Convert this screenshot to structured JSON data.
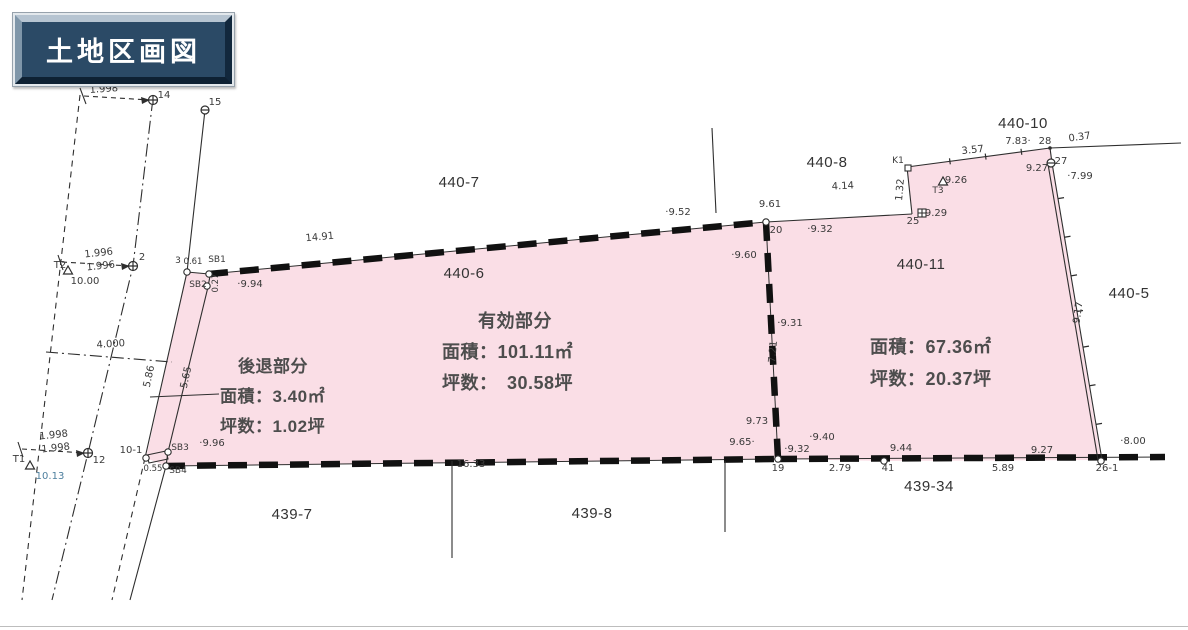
{
  "title": "土地区画図",
  "colors": {
    "parcel_fill": "#fadee6",
    "line": "#2e2e2e",
    "boundary": "#111111",
    "title_bg": "#2b4a66",
    "title_text": "#ffffff",
    "label_gray": "#3a3a3a",
    "elevation_blue": "#4d7f9e"
  },
  "info_blocks": {
    "effective": {
      "heading": "有効部分",
      "area": "面積：101.11㎡",
      "tsubo": "坪数：　30.58坪"
    },
    "setback": {
      "heading": "後退部分",
      "area": "面積：3.40㎡",
      "tsubo": "坪数：1.02坪"
    },
    "parcel_440_11": {
      "area": "面積：67.36㎡",
      "tsubo": "坪数：20.37坪"
    }
  },
  "parcel_labels": [
    {
      "t": "440-7",
      "x": 459,
      "y": 187
    },
    {
      "t": "440-8",
      "x": 827,
      "y": 167
    },
    {
      "t": "440-10",
      "x": 1023,
      "y": 128
    },
    {
      "t": "440-5",
      "x": 1129,
      "y": 298
    },
    {
      "t": "440-6",
      "x": 464,
      "y": 278
    },
    {
      "t": "440-11",
      "x": 921,
      "y": 269
    },
    {
      "t": "439-7",
      "x": 292,
      "y": 519
    },
    {
      "t": "439-8",
      "x": 592,
      "y": 518
    },
    {
      "t": "439-34",
      "x": 929,
      "y": 491
    }
  ],
  "survey_labels": [
    {
      "t": "1.998",
      "x": 104,
      "y": 92,
      "r": -4
    },
    {
      "t": "14",
      "x": 164,
      "y": 98
    },
    {
      "t": "15",
      "x": 215,
      "y": 105
    },
    {
      "t": "1.996",
      "x": 99,
      "y": 256,
      "r": -6
    },
    {
      "t": "1.996",
      "x": 101,
      "y": 269,
      "r": -6
    },
    {
      "t": "2",
      "x": 142,
      "y": 260
    },
    {
      "t": "T2",
      "x": 60,
      "y": 268
    },
    {
      "t": "10.00",
      "x": 85,
      "y": 284
    },
    {
      "t": "4.000",
      "x": 111,
      "y": 347,
      "r": -4
    },
    {
      "t": "5.86",
      "x": 152,
      "y": 377,
      "r": -78
    },
    {
      "t": "5.65",
      "x": 189,
      "y": 378,
      "r": -78
    },
    {
      "t": "1.998",
      "x": 54,
      "y": 438,
      "r": -6
    },
    {
      "t": "1.998",
      "x": 56,
      "y": 451,
      "r": -6
    },
    {
      "t": "12",
      "x": 99,
      "y": 463
    },
    {
      "t": "T1",
      "x": 19,
      "y": 462
    },
    {
      "t": "10.13",
      "x": 50,
      "y": 479,
      "c": "blue"
    },
    {
      "t": "10-1",
      "x": 131,
      "y": 453
    },
    {
      "t": "0.55",
      "x": 153,
      "y": 471,
      "s": 8.5
    },
    {
      "t": "SB3",
      "x": 180,
      "y": 450,
      "s": 9
    },
    {
      "t": "SB4",
      "x": 178,
      "y": 473,
      "s": 9
    },
    {
      "t": "3",
      "x": 178,
      "y": 263,
      "s": 9
    },
    {
      "t": "0.61",
      "x": 193,
      "y": 264,
      "s": 8.5
    },
    {
      "t": "SB1",
      "x": 217,
      "y": 262,
      "s": 9
    },
    {
      "t": "SB2",
      "x": 198,
      "y": 287,
      "s": 9
    },
    {
      "t": "0.27",
      "x": 218,
      "y": 283,
      "r": -90,
      "s": 8.5
    },
    {
      "t": "·9.96",
      "x": 212,
      "y": 446
    },
    {
      "t": "·9.94",
      "x": 250,
      "y": 287
    },
    {
      "t": "14.91",
      "x": 320,
      "y": 240,
      "r": -5
    },
    {
      "t": "·9.52",
      "x": 678,
      "y": 215
    },
    {
      "t": "16.33",
      "x": 471,
      "y": 467
    },
    {
      "t": "9.61",
      "x": 770,
      "y": 207
    },
    {
      "t": "20",
      "x": 776,
      "y": 233
    },
    {
      "t": "·9.60",
      "x": 744,
      "y": 258
    },
    {
      "t": "·9.31",
      "x": 790,
      "y": 326
    },
    {
      "t": "7.21",
      "x": 776,
      "y": 352,
      "r": -85
    },
    {
      "t": "9.73",
      "x": 757,
      "y": 424
    },
    {
      "t": "9.65·",
      "x": 742,
      "y": 445
    },
    {
      "t": "·9.32",
      "x": 797,
      "y": 452
    },
    {
      "t": "19",
      "x": 778,
      "y": 471
    },
    {
      "t": "·9.40",
      "x": 822,
      "y": 440
    },
    {
      "t": "2.79",
      "x": 840,
      "y": 471
    },
    {
      "t": "4.14",
      "x": 843,
      "y": 189,
      "r": -3
    },
    {
      "t": "·9.32",
      "x": 820,
      "y": 232
    },
    {
      "t": "K1",
      "x": 898,
      "y": 163,
      "s": 9
    },
    {
      "t": "1.32",
      "x": 903,
      "y": 190,
      "r": -85
    },
    {
      "t": "9.29",
      "x": 936,
      "y": 216
    },
    {
      "t": "25",
      "x": 913,
      "y": 224
    },
    {
      "t": "T3",
      "x": 938,
      "y": 193,
      "s": 9
    },
    {
      "t": "9.26",
      "x": 956,
      "y": 183
    },
    {
      "t": "3.57",
      "x": 973,
      "y": 153,
      "r": -6
    },
    {
      "t": "7.83·",
      "x": 1018,
      "y": 144
    },
    {
      "t": "28",
      "x": 1045,
      "y": 144
    },
    {
      "t": "0.37",
      "x": 1080,
      "y": 140,
      "r": -8
    },
    {
      "t": "27",
      "x": 1061,
      "y": 164
    },
    {
      "t": "9.27",
      "x": 1037,
      "y": 171
    },
    {
      "t": "·7.99",
      "x": 1080,
      "y": 179
    },
    {
      "t": "9.17",
      "x": 1081,
      "y": 313,
      "r": -82
    },
    {
      "t": "·8.00",
      "x": 1133,
      "y": 444
    },
    {
      "t": "9.27",
      "x": 1042,
      "y": 453
    },
    {
      "t": "26-1",
      "x": 1107,
      "y": 471
    },
    {
      "t": "5.89",
      "x": 1003,
      "y": 471
    },
    {
      "t": "9.44",
      "x": 901,
      "y": 451
    },
    {
      "t": "41",
      "x": 888,
      "y": 471
    }
  ],
  "markers": [
    {
      "type": "circle-cross",
      "x": 153,
      "y": 100,
      "name": "point-14-marker"
    },
    {
      "type": "circle-cross",
      "x": 133,
      "y": 266,
      "name": "point-2-marker"
    },
    {
      "type": "circle-cross",
      "x": 88,
      "y": 453,
      "name": "point-12-marker"
    },
    {
      "type": "circle-bar",
      "x": 205,
      "y": 110,
      "name": "point-15-marker"
    },
    {
      "type": "circle-bar",
      "x": 1051,
      "y": 163,
      "name": "point-27-marker"
    },
    {
      "type": "circle",
      "x": 187,
      "y": 272,
      "name": "point-3-marker"
    },
    {
      "type": "circle",
      "x": 209,
      "y": 274,
      "name": "point-sb1-marker"
    },
    {
      "type": "circle",
      "x": 207,
      "y": 286,
      "name": "point-sb2-marker"
    },
    {
      "type": "circle",
      "x": 168,
      "y": 452,
      "name": "point-sb3-marker"
    },
    {
      "type": "circle",
      "x": 166,
      "y": 466,
      "name": "point-sb4-marker"
    },
    {
      "type": "circle",
      "x": 146,
      "y": 458,
      "name": "point-10-1-marker"
    },
    {
      "type": "circle",
      "x": 766,
      "y": 222,
      "name": "point-20-marker"
    },
    {
      "type": "circle",
      "x": 778,
      "y": 459,
      "name": "point-19-marker"
    },
    {
      "type": "circle",
      "x": 884,
      "y": 461,
      "name": "point-41-marker"
    },
    {
      "type": "circle",
      "x": 1101,
      "y": 461,
      "name": "point-26-1-marker"
    },
    {
      "type": "square-cross",
      "x": 922,
      "y": 213,
      "name": "point-25-marker"
    },
    {
      "type": "square",
      "x": 908,
      "y": 168,
      "name": "point-k1-marker"
    },
    {
      "type": "triangle",
      "x": 30,
      "y": 466,
      "name": "point-t1-marker"
    },
    {
      "type": "triangle",
      "x": 68,
      "y": 271,
      "name": "point-t2-marker"
    },
    {
      "type": "triangle",
      "x": 943,
      "y": 182,
      "name": "point-t3-marker"
    },
    {
      "type": "dot",
      "x": 1050,
      "y": 148,
      "name": "point-28-marker"
    }
  ]
}
